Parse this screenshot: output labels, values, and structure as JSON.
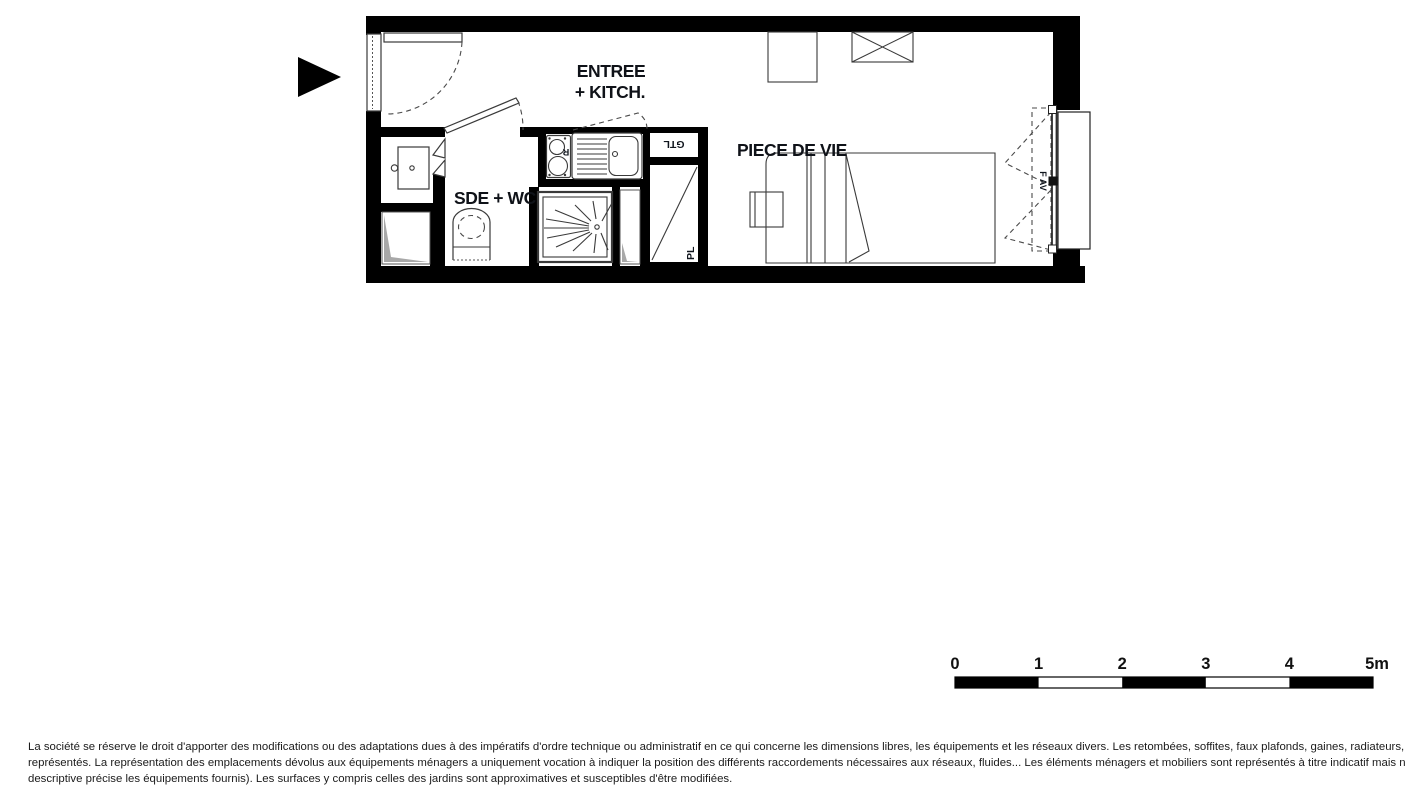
{
  "plan": {
    "labels": {
      "entry_line1": "ENTREE",
      "entry_line2": "+ KITCH.",
      "bathroom": "SDE + WC",
      "living_room": "PIECE DE VIE",
      "technical_box": "GTL",
      "closet": "PL",
      "window": "F AV",
      "fridge_mark": "R"
    },
    "colors": {
      "walls": "#000000",
      "fixture_lines": "#3a3a3a",
      "labels": "#0f1218",
      "fridge_mark": "#b3560e",
      "duct_shading": "#a8a8a8"
    }
  },
  "scale_bar": {
    "ticks": [
      "0",
      "1",
      "2",
      "3",
      "4"
    ],
    "end_label": "5m"
  },
  "disclaimer": {
    "line1": "La société se réserve le droit d'apporter des modifications ou des adaptations dues à des impératifs d'ordre technique ou administratif en ce qui concerne les dimensions libres, les équipements et les réseaux divers. Les retombées, soffites, faux plafonds, gaines, radiateurs, s'ils existent, ne sont pas tous",
    "line2": "représentés. La représentation des emplacements dévolus aux équipements ménagers a uniquement vocation à indiquer la position des différents raccordements nécessaires aux réseaux, fluides... Les éléments ménagers et mobiliers sont représentés à titre indicatif mais ne sont pas tous fournis (seule la notice",
    "line3": "descriptive précise les équipements fournis). Les surfaces y compris celles des jardins sont approximatives et susceptibles d'être modifiées."
  }
}
